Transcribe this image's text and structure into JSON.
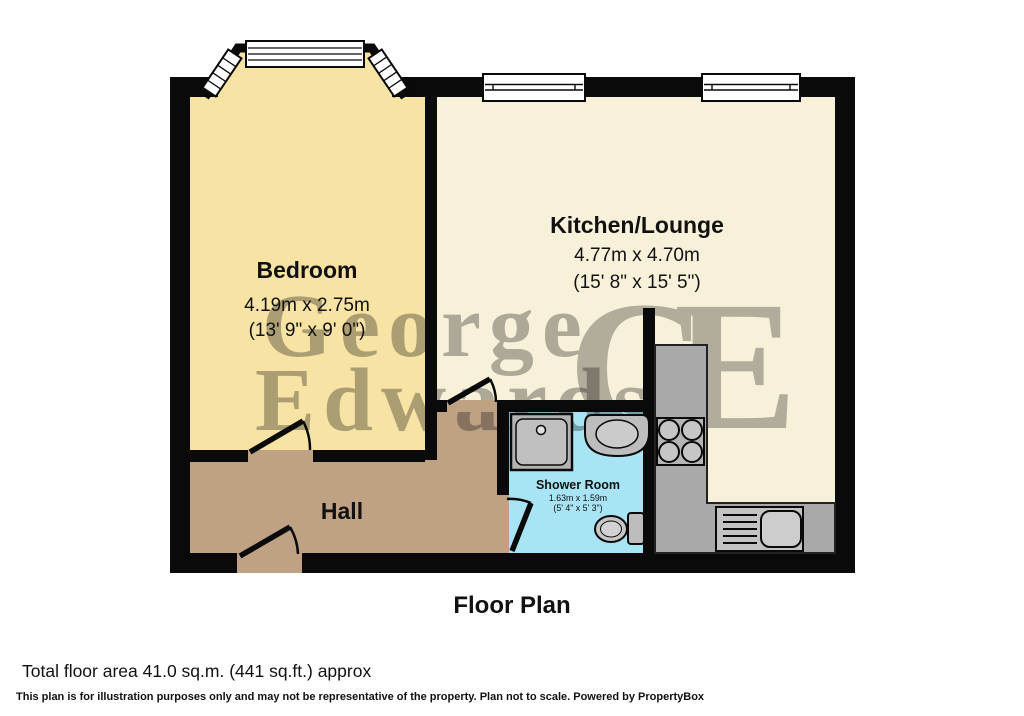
{
  "plan": {
    "title": "Floor Plan",
    "total_area": "Total floor area 41.0 sq.m. (441 sq.ft.) approx",
    "disclaimer": "This plan is for illustration purposes only and may not be representative of the property. Plan not to scale. Powered by PropertyBox"
  },
  "rooms": {
    "bedroom": {
      "name": "Bedroom",
      "dims_m": "4.19m x 2.75m",
      "dims_ft": "(13' 9\" x 9' 0\")"
    },
    "kitchen_lounge": {
      "name": "Kitchen/Lounge",
      "dims_m": "4.77m x 4.70m",
      "dims_ft": "(15' 8\" x 15' 5\")"
    },
    "hall": {
      "name": "Hall"
    },
    "shower_room": {
      "name": "Shower Room",
      "dims_m": "1.63m x 1.59m",
      "dims_ft": "(5' 4\" x 5' 3\")"
    }
  },
  "watermark": {
    "line1": "George",
    "line2": "Edwards",
    "monogram": "GE"
  },
  "colors": {
    "bedroom": "#f7e3a3",
    "kitchen_lounge": "#f8f1da",
    "hall": "#bfa283",
    "shower_room": "#a9e4f5",
    "wall": "#0a0a0a",
    "counter": "#a9a9a9",
    "window": "#ffffff",
    "watermark_text": "#958748",
    "watermark_monogram": "#c3b577"
  }
}
